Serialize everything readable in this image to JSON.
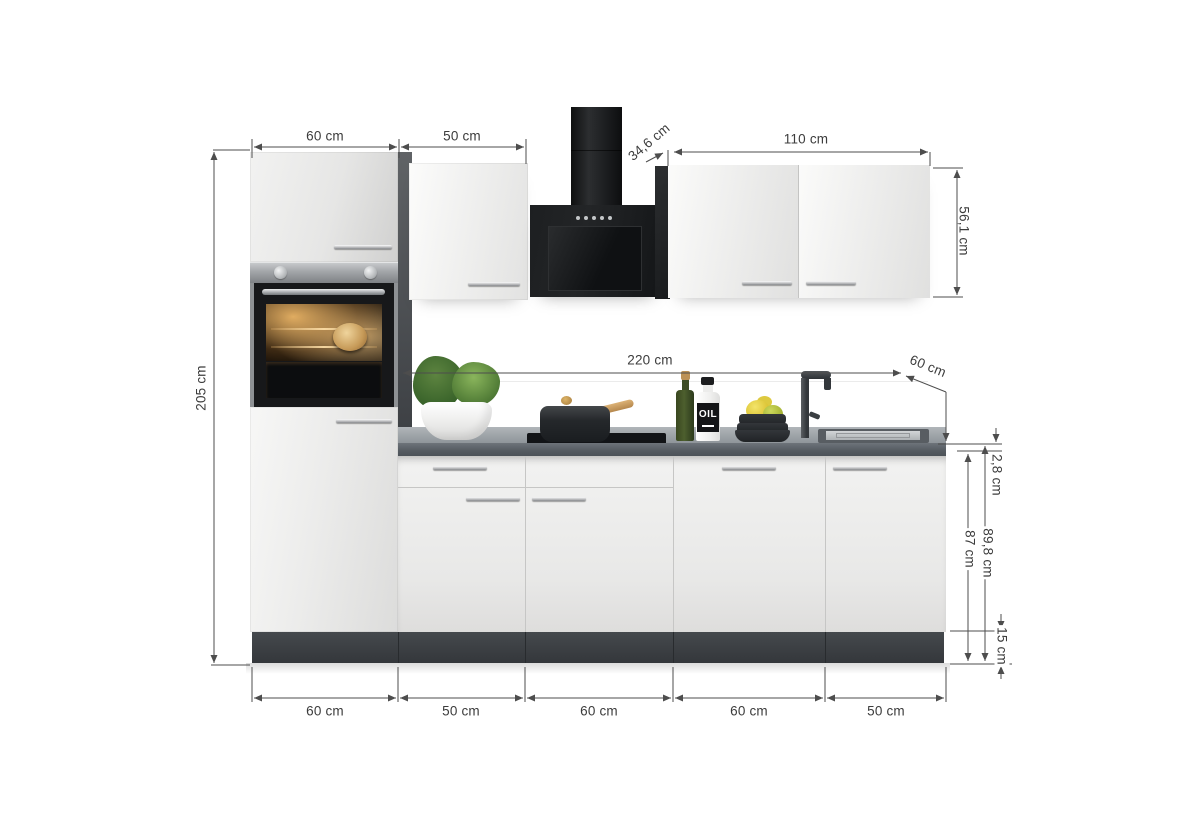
{
  "dimensions": {
    "top": [
      {
        "id": "tall-unit-width",
        "label": "60 cm"
      },
      {
        "id": "upper-cabinet-width",
        "label": "50 cm"
      },
      {
        "id": "wall-cabinet-depth",
        "label": "34,6 cm"
      },
      {
        "id": "wall-cabinet-width",
        "label": "110 cm"
      },
      {
        "id": "wall-cabinet-height",
        "label": "56,1 cm"
      }
    ],
    "left": {
      "id": "total-height",
      "label": "205 cm"
    },
    "worktop": {
      "length_label": "220 cm",
      "depth_label": "60 cm"
    },
    "right": [
      {
        "id": "worktop-thickness",
        "label": "2,8 cm"
      },
      {
        "id": "base-cabinet-height",
        "label": "87 cm"
      },
      {
        "id": "base-with-worktop-height",
        "label": "89,8 cm"
      },
      {
        "id": "plinth-height",
        "label": "15 cm"
      }
    ],
    "bottom": [
      {
        "id": "base-1-width",
        "label": "60 cm"
      },
      {
        "id": "base-2-width",
        "label": "50 cm"
      },
      {
        "id": "base-3-width",
        "label": "60 cm"
      },
      {
        "id": "base-4-width",
        "label": "60 cm"
      },
      {
        "id": "base-5-width",
        "label": "50 cm"
      }
    ]
  },
  "props": {
    "oil_bottle_label": "OIL"
  },
  "colors": {
    "dimension_line": "#4d4d4d",
    "label_text": "#3c3c3c",
    "cabinet_front": "#ededec",
    "carcass_dark": "#3f4347",
    "worktop": "#5b6167",
    "plinth": "#3d4145",
    "hood": "#1b1d1f",
    "steel": "#a3a6a9"
  }
}
